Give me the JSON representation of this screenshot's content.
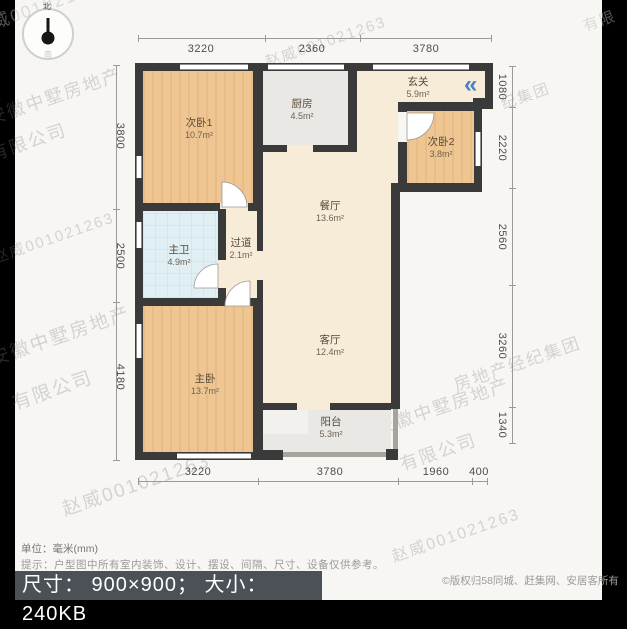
{
  "compass": {
    "north_label": "北",
    "south_label": "南"
  },
  "rooms": [
    {
      "name": "次卧1",
      "area": "10.7m²"
    },
    {
      "name": "厨房",
      "area": "4.5m²"
    },
    {
      "name": "玄关",
      "area": "5.9m²"
    },
    {
      "name": "次卧2",
      "area": "3.8m²"
    },
    {
      "name": "餐厅",
      "area": "13.6m²"
    },
    {
      "name": "过道",
      "area": "2.1m²"
    },
    {
      "name": "主卫",
      "area": "4.9m²"
    },
    {
      "name": "主卧",
      "area": "13.7m²"
    },
    {
      "name": "客厅",
      "area": "12.4m²"
    },
    {
      "name": "阳台",
      "area": "5.3m²"
    }
  ],
  "dims": {
    "top": [
      "3220",
      "2360",
      "3780"
    ],
    "bottom": [
      "3220",
      "3780",
      "1960",
      "400"
    ],
    "left": [
      "3800",
      "2500",
      "4180"
    ],
    "right": [
      "1080",
      "2220",
      "2560",
      "3260",
      "1340"
    ]
  },
  "entry": {
    "glyph": "«"
  },
  "watermarks": [
    "赵威001021263",
    "赵威001021263",
    "安徽中墅房地产",
    "有限公司",
    "安徽中墅",
    "限公司",
    "赵威001021263",
    "安徽中墅房地产",
    "有限公司",
    "房地产经纪集团",
    "安徽中墅房地产",
    "有限公司",
    "赵威001021263",
    "赵威001021263",
    "有限",
    "纪集团"
  ],
  "footer": {
    "unit_line": "单位：毫米(mm)",
    "hint_line": "提示：户型图中所有室内装饰、设计、摆设、间隔、尺寸、设备仅供参考。",
    "size_bar": "尺寸： 900×900； 大小： 240KB",
    "copyright": "©版权归58同城、赶集网、安居客所有"
  },
  "colors": {
    "wood": "#efc692",
    "cream": "#f6ecd8",
    "gray_room": "#e9e8e4",
    "bath": "#e0eff3",
    "wall": "#3a3a3a",
    "arrow_blue": "#4a80c9"
  }
}
